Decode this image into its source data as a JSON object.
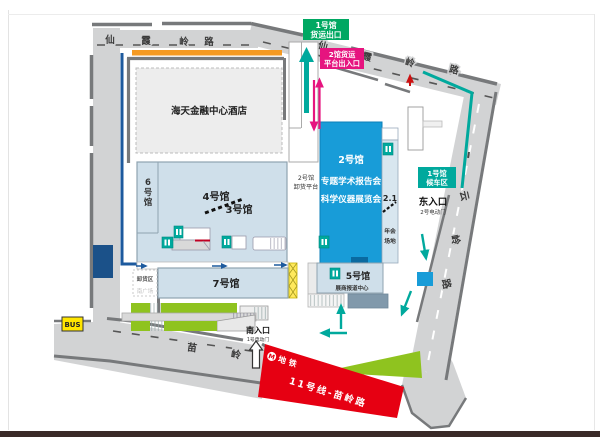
{
  "colors": {
    "road_fill": "#d2d3d4",
    "road_border": "#77797b",
    "hall_fill": "#cfdfea",
    "hall_border": "#8fa3b0",
    "hall2_blue": "#189cd8",
    "teal_arrow": "#00a99d",
    "green_label_bg": "#00a862",
    "teal_label_bg": "#00a99d",
    "pink": "#e6147f",
    "metro_red": "#e60012",
    "orange_bar": "#f59a23",
    "bus_yellow": "#ffe600",
    "escalator_green": "#8fc31f",
    "navy": "#1d5a9e",
    "hotel_fill": "#ededed"
  },
  "roads": {
    "top": [
      "仙",
      "霞",
      "岭",
      "路"
    ],
    "diag": [
      "仙",
      "霞",
      "岭",
      "路"
    ],
    "east": [
      "云",
      "岭",
      "路"
    ],
    "south": [
      "苗",
      "岭"
    ]
  },
  "halls": {
    "hotel": "海天金融中心酒店",
    "hall6": [
      "6",
      "号",
      "馆"
    ],
    "hall4": "4号馆",
    "hall3": "3号馆",
    "hall7": "7号馆",
    "hall5": "5号馆",
    "hall2_title": "2号馆",
    "hall2_sub1": "专题学术报告会",
    "hall2_sub2": "科学仪器展览会",
    "area21": "2.1",
    "annual1": "年会",
    "annual2": "场地",
    "exhibitor_center": "展商报道中心",
    "unload_platform1": "2号馆",
    "unload_platform2": "卸货平台",
    "unload_zone": "卸货区",
    "south_plaza": "南广场"
  },
  "labels": {
    "freight_exit1": "1号馆",
    "freight_exit2": "货运出口",
    "freight_platform1": "2馆货运",
    "freight_platform2": "平台出入口",
    "waiting1": "1号馆",
    "waiting2": "候车区",
    "east_entrance": "东入口",
    "east_gate": "2号电动门",
    "south_entrance": "南入口",
    "south_gate": "1号电动门",
    "bus": "BUS",
    "metro_m": "M",
    "metro": "地铁",
    "metro_line": "11号线-苗岭路"
  }
}
